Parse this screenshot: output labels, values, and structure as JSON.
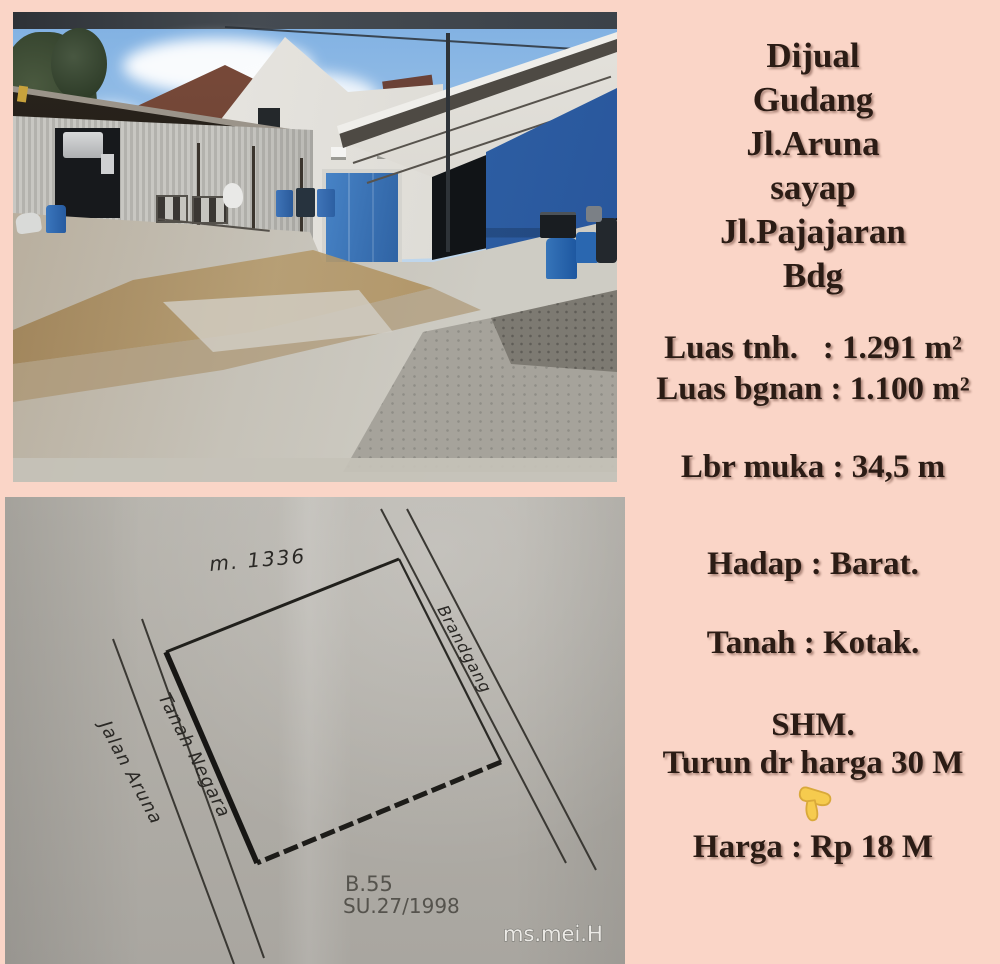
{
  "page": {
    "background_color": "#fad5c7"
  },
  "listing": {
    "text_color": "#2b1c15",
    "header_lines": [
      "Dijual",
      "Gudang",
      "Jl.Aruna",
      "sayap",
      "Jl.Pajajaran",
      "Bdg"
    ],
    "land_area_line": "Luas tnh.   : 1.291 m²",
    "building_area_line": "Luas bgnan : 1.100 m²",
    "frontage_line": "Lbr muka : 34,5 m",
    "facing_line": "Hadap : Barat.",
    "land_shape_line": "Tanah : Kotak.",
    "certificate_line": "SHM.",
    "discount_line": "Turun dr harga 30 M",
    "price_line": "Harga : Rp 18 M",
    "pointer_icon": "pointing-down-hand-emoji",
    "pointer_color": "#f6cb4e"
  },
  "photo": {
    "door_blue": "#2f66ab",
    "sky_blue": "#7fb0e2"
  },
  "sketch": {
    "paper_color": "#b2afa8",
    "labels": {
      "survey_number": "m. 1336",
      "right_road": "Brandgang",
      "left_road_side": "Tanah Negara",
      "left_road": "Jalan Aruna",
      "block": "B.55",
      "survey_doc": "SU.27/1998"
    },
    "watermark": "ms.mei.H"
  }
}
